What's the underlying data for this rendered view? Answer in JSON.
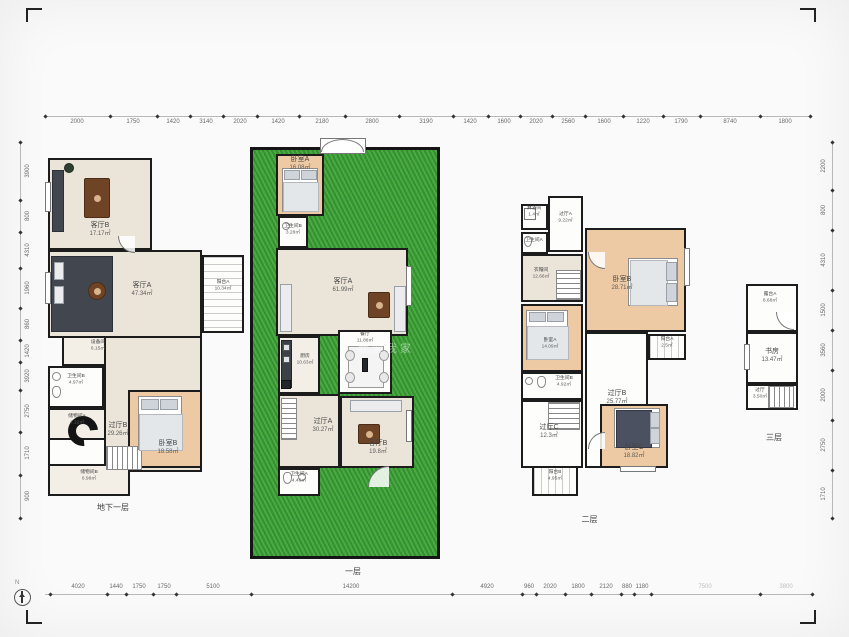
{
  "compass": {
    "label": "N"
  },
  "watermark": "我爱我家",
  "plans": {
    "basement": {
      "floor_label": "地下一层",
      "rooms": [
        {
          "name": "客厅B",
          "area": "17.17㎡"
        },
        {
          "name": "客厅A",
          "area": "47.34㎡"
        },
        {
          "name": "阳台A",
          "area": "10.34㎡"
        },
        {
          "name": "设备间",
          "area": "6.15㎡"
        },
        {
          "name": "卫生间B",
          "area": "4.97㎡"
        },
        {
          "name": "储物间A",
          "area": "4.12㎡"
        },
        {
          "name": "过厅B",
          "area": "29.26㎡"
        },
        {
          "name": "卧室B",
          "area": "18.58㎡"
        },
        {
          "name": "储物间B",
          "area": "6.98㎡"
        }
      ]
    },
    "first": {
      "floor_label": "一层",
      "rooms": [
        {
          "name": "卧室A",
          "area": "16.08㎡"
        },
        {
          "name": "卫生间B",
          "area": "3.28㎡"
        },
        {
          "name": "客厅A",
          "area": "61.99㎡"
        },
        {
          "name": "厨房",
          "area": "10.63㎡"
        },
        {
          "name": "餐厅",
          "area": "11.86㎡"
        },
        {
          "name": "过厅A",
          "area": "30.27㎡"
        },
        {
          "name": "客厅B",
          "area": "19.8㎡"
        },
        {
          "name": "卫生间A",
          "area": "4.46㎡"
        }
      ]
    },
    "second": {
      "floor_label": "二层",
      "rooms": [
        {
          "name": "淋浴间",
          "area": "1.4㎡"
        },
        {
          "name": "卫生间A",
          "area": ""
        },
        {
          "name": "过厅A",
          "area": "9.22㎡"
        },
        {
          "name": "衣帽间",
          "area": "12.66㎡"
        },
        {
          "name": "卧室B",
          "area": "28.71㎡"
        },
        {
          "name": "卧室A",
          "area": "14.09㎡"
        },
        {
          "name": "卫生间B",
          "area": "4.92㎡"
        },
        {
          "name": "过厅B",
          "area": "25.77㎡"
        },
        {
          "name": "过厅C",
          "area": "12.3㎡"
        },
        {
          "name": "阳台A",
          "area": "2.5㎡"
        },
        {
          "name": "卧室C",
          "area": "18.82㎡"
        },
        {
          "name": "阳台B",
          "area": "4.95㎡"
        }
      ]
    },
    "third": {
      "floor_label": "三层",
      "rooms": [
        {
          "name": "露台A",
          "area": "8.68㎡"
        },
        {
          "name": "书房",
          "area": "13.47㎡"
        },
        {
          "name": "过厅",
          "area": "3.50㎡"
        }
      ]
    }
  },
  "rulers": [
    {
      "orient": "h",
      "at": 116,
      "from": 45,
      "to": 810,
      "side": "below",
      "ticks": [
        45,
        110,
        157,
        190,
        223,
        257,
        299,
        345,
        399,
        453,
        488,
        520,
        552,
        585,
        623,
        663,
        700,
        760,
        810
      ],
      "labels": [
        {
          "pos": 77,
          "t": "2000"
        },
        {
          "pos": 133,
          "t": "1750"
        },
        {
          "pos": 173,
          "t": "1420"
        },
        {
          "pos": 206,
          "t": "3140"
        },
        {
          "pos": 240,
          "t": "2020"
        },
        {
          "pos": 278,
          "t": "1420"
        },
        {
          "pos": 322,
          "t": "2180"
        },
        {
          "pos": 372,
          "t": "2800"
        },
        {
          "pos": 426,
          "t": "3190"
        },
        {
          "pos": 470,
          "t": "1420"
        },
        {
          "pos": 504,
          "t": "1600"
        },
        {
          "pos": 536,
          "t": "2020"
        },
        {
          "pos": 568,
          "t": "2560"
        },
        {
          "pos": 604,
          "t": "1600"
        },
        {
          "pos": 643,
          "t": "1220"
        },
        {
          "pos": 681,
          "t": "1790"
        },
        {
          "pos": 730,
          "t": "8740"
        },
        {
          "pos": 785,
          "t": "1800"
        }
      ]
    },
    {
      "orient": "h",
      "at": 594,
      "from": 45,
      "to": 812,
      "side": "above",
      "ticks": [
        50,
        107,
        126,
        153,
        176,
        251,
        452,
        522,
        536,
        565,
        591,
        621,
        634,
        651,
        760,
        812
      ],
      "labels": [
        {
          "pos": 78,
          "t": "4020"
        },
        {
          "pos": 116,
          "t": "1440"
        },
        {
          "pos": 139,
          "t": "1750"
        },
        {
          "pos": 164,
          "t": "1750"
        },
        {
          "pos": 213,
          "t": "5100"
        },
        {
          "pos": 351,
          "t": "14200"
        },
        {
          "pos": 487,
          "t": "4920"
        },
        {
          "pos": 529,
          "t": "960"
        },
        {
          "pos": 550,
          "t": "2020"
        },
        {
          "pos": 578,
          "t": "1800"
        },
        {
          "pos": 606,
          "t": "2120"
        },
        {
          "pos": 627,
          "t": "880"
        },
        {
          "pos": 642,
          "t": "1180"
        },
        {
          "pos": 705,
          "t": "7500",
          "light": true
        },
        {
          "pos": 786,
          "t": "3800",
          "light": true
        }
      ]
    },
    {
      "orient": "v",
      "at": 20,
      "from": 142,
      "to": 518,
      "side": "left",
      "ticks": [
        142,
        200,
        232,
        268,
        308,
        340,
        362,
        390,
        432,
        475,
        518
      ],
      "labels": [
        {
          "pos": 171,
          "t": "3900"
        },
        {
          "pos": 216,
          "t": "800"
        },
        {
          "pos": 250,
          "t": "4310"
        },
        {
          "pos": 288,
          "t": "1960"
        },
        {
          "pos": 324,
          "t": "860"
        },
        {
          "pos": 351,
          "t": "1420"
        },
        {
          "pos": 376,
          "t": "3920"
        },
        {
          "pos": 411,
          "t": "2750"
        },
        {
          "pos": 453,
          "t": "1710"
        },
        {
          "pos": 496,
          "t": "900"
        }
      ]
    },
    {
      "orient": "v",
      "at": 832,
      "from": 142,
      "to": 518,
      "side": "right",
      "ticks": [
        142,
        190,
        230,
        290,
        330,
        370,
        420,
        470,
        518
      ],
      "labels": [
        {
          "pos": 166,
          "t": "2200"
        },
        {
          "pos": 210,
          "t": "800"
        },
        {
          "pos": 260,
          "t": "4310"
        },
        {
          "pos": 310,
          "t": "1500"
        },
        {
          "pos": 350,
          "t": "3560"
        },
        {
          "pos": 395,
          "t": "2000"
        },
        {
          "pos": 445,
          "t": "2750"
        },
        {
          "pos": 494,
          "t": "1710"
        }
      ]
    }
  ]
}
